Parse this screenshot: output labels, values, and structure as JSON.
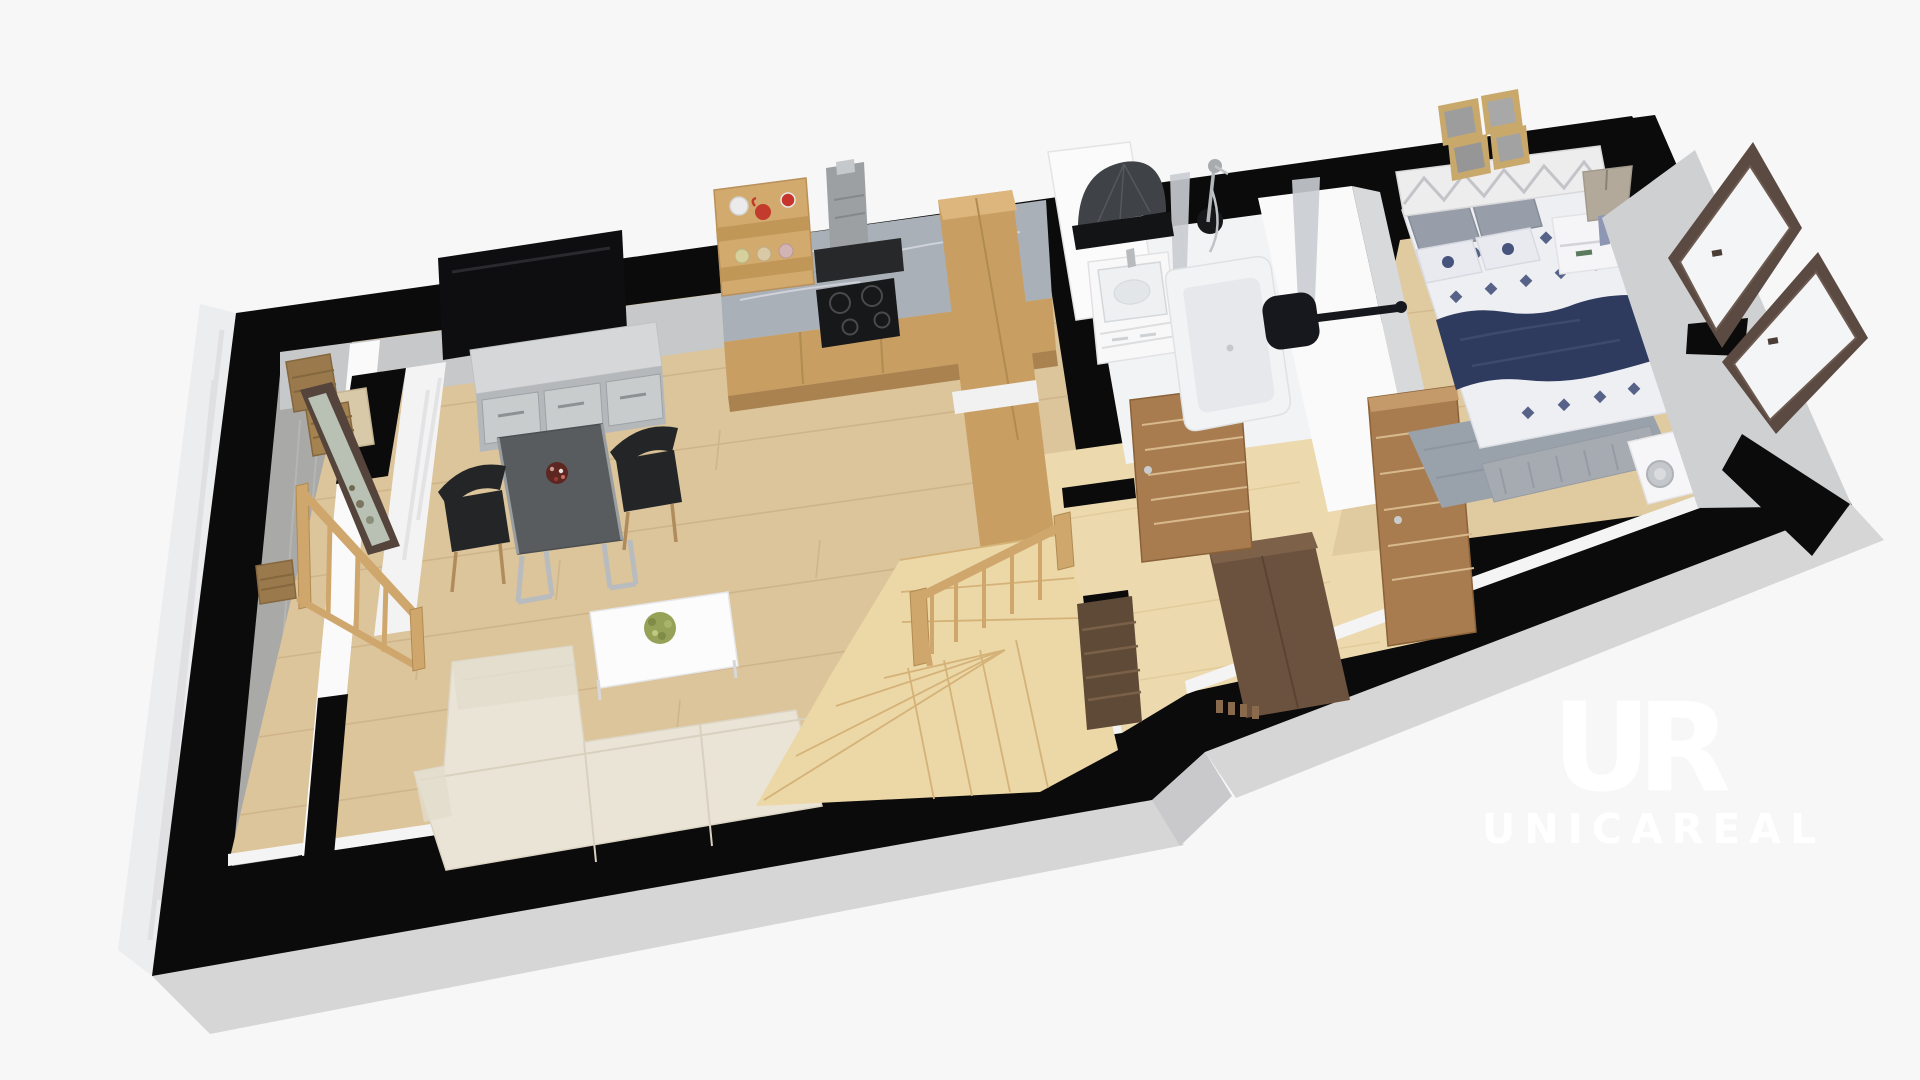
{
  "watermark": {
    "logo": "UR",
    "brand": "UNICAREAL"
  },
  "colors": {
    "background": "#f7f7f8",
    "wall_black": "#0b0b0b",
    "outer_face_gray": "#d6d6d7",
    "outer_face_light": "#ecedee",
    "inner_face_gray": "#c7c8c9",
    "east_face_gray": "#cfd0d2",
    "white_wall": "#fafafa",
    "wood_floor": "#dcc49b",
    "wood_floor_line": "#c8ad80",
    "birch_floor": "#ecd9ae",
    "concrete_floor": "#a9a9a7",
    "bathroom_floor": "#f2f3f4",
    "stairs_wood": "#ecd7a6",
    "railing_wood": "#cfa76d",
    "cabinet_wood": "#c89e63",
    "cabinet_wood_light": "#dcb67c",
    "counter_marble": "#aab0b8",
    "cooktop_black": "#17181a",
    "hood_gray": "#9da0a3",
    "sofa_cream": "#eae4d6",
    "sofa_seam": "#d8d1c0",
    "table_dark": "#595c5e",
    "chair_black": "#232527",
    "coffee_table_white": "#fcfcfd",
    "plant_green": "#95a258",
    "sideboard_concrete": "#b5b8ba",
    "sideboard_top": "#d5d7d8",
    "tv_black": "#0e0e10",
    "door_brown": "#a87c4f",
    "door_groove": "#d8b98d",
    "wardrobe_dark": "#6b523e",
    "bench_dark": "#5f4a38",
    "bed_duvet": "#edeff3",
    "bed_navy": "#2e3a5e",
    "pattern_navy": "#46537c",
    "pillow_gray": "#989ea9",
    "headboard_white": "#ededee",
    "rug_gray": "#99a1ab",
    "nightstand_white": "#f5f5f7",
    "lamp_shade": "#b2a99b",
    "frame_wood": "#c9a86b",
    "window_frame": "#5b4a41",
    "window_glass": "#f4f5f7",
    "chrome": "#c2c5c8",
    "wicker": "#9a7a4c",
    "mirror_dark": "#3f4247",
    "tub_white": "#f2f3f4",
    "tub_inner": "#e6e8eb",
    "towel_bar_black": "#17181d",
    "watermark_white": "#ffffff"
  },
  "scene": {
    "type": "3d-floorplan-render",
    "level": "cutaway top-down perspective",
    "rooms": [
      {
        "name": "entry",
        "items": [
          "concrete-floor",
          "leaning-mirror",
          "wicker-baskets",
          "storage-bench",
          "wood-railing"
        ]
      },
      {
        "name": "living-room",
        "items": [
          "wall-tv",
          "concrete-sideboard",
          "dining-table",
          "black-chair",
          "black-chair",
          "fruit-bowl",
          "sectional-sofa",
          "coffee-table",
          "potted-plant",
          "oak-plank-floor"
        ]
      },
      {
        "name": "kitchen",
        "items": [
          "marble-counter",
          "base-cabinets",
          "induction-cooktop",
          "extractor-hood",
          "open-shelf",
          "jars",
          "tall-cabinet"
        ]
      },
      {
        "name": "hallway",
        "items": [
          "winder-staircase",
          "stair-railing",
          "shoe-bench",
          "dark-wardrobe",
          "coat-hooks",
          "interior-door",
          "birch-floor"
        ]
      },
      {
        "name": "bathroom",
        "items": [
          "vanity-sink",
          "bathtub",
          "shower-set",
          "fan-mirror",
          "black-shelf",
          "towel-radiator",
          "glass-partition",
          "interior-door"
        ]
      },
      {
        "name": "bedroom",
        "items": [
          "double-bed",
          "patterned-duvet",
          "navy-throw",
          "pillows",
          "lattice-headboard",
          "picture-frames",
          "nightstand",
          "table-lamp",
          "foot-bench",
          "gray-rug",
          "vanity-desk",
          "chrome-stool",
          "tilted-window",
          "tilted-window"
        ]
      }
    ]
  }
}
